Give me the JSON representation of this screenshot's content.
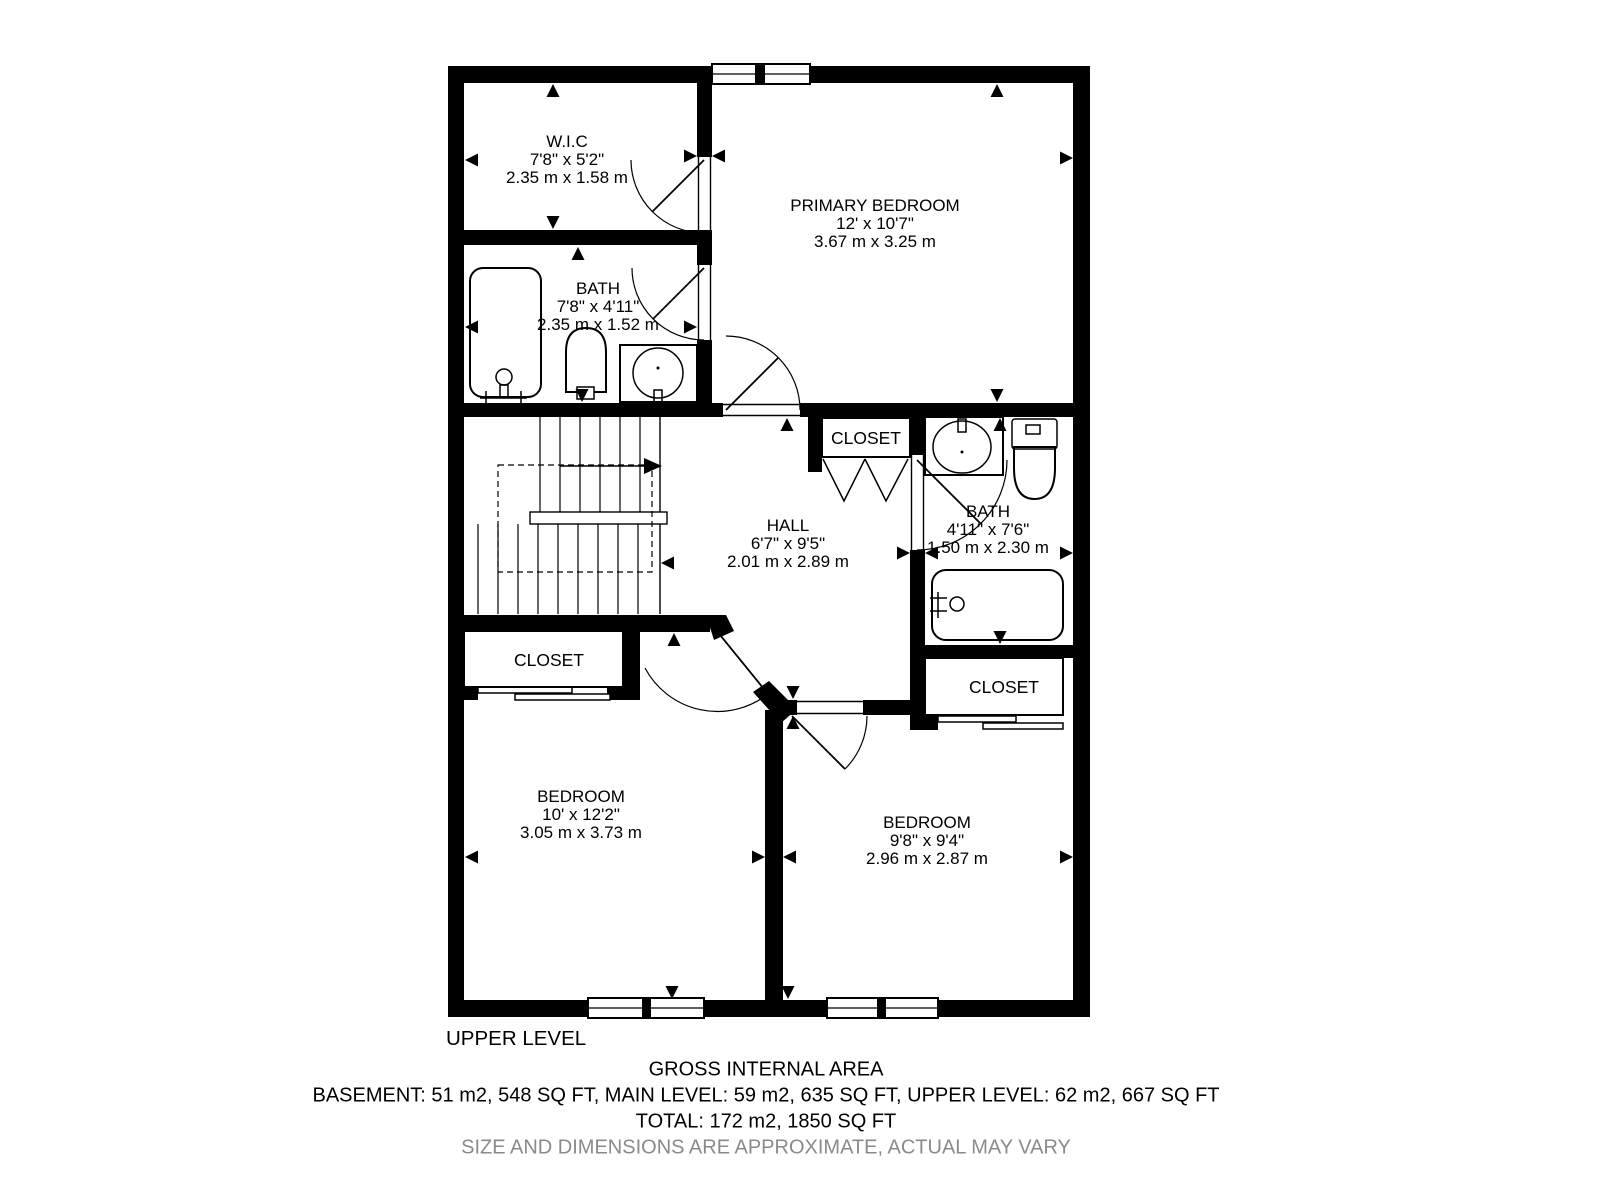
{
  "plan": {
    "level_label": "UPPER LEVEL",
    "rooms": {
      "wic": {
        "name": "W.I.C",
        "imperial": "7'8\" x 5'2\"",
        "metric": "2.35 m x 1.58 m"
      },
      "primary_bedroom": {
        "name": "PRIMARY BEDROOM",
        "imperial": "12' x 10'7\"",
        "metric": "3.67 m x 3.25 m"
      },
      "bath_upper": {
        "name": "BATH",
        "imperial": "7'8\" x 4'11\"",
        "metric": "2.35 m x 1.52 m"
      },
      "hall": {
        "name": "HALL",
        "imperial": "6'7\" x 9'5\"",
        "metric": "2.01 m x 2.89 m"
      },
      "bath_right": {
        "name": "BATH",
        "imperial": "4'11\" x 7'6\"",
        "metric": "1.50 m x 2.30 m"
      },
      "bedroom_left": {
        "name": "BEDROOM",
        "imperial": "10' x 12'2\"",
        "metric": "3.05 m x 3.73 m"
      },
      "bedroom_right": {
        "name": "BEDROOM",
        "imperial": "9'8\" x 9'4\"",
        "metric": "2.96 m x 2.87 m"
      }
    },
    "closets": {
      "hall_closet": "CLOSET",
      "left_bedroom_closet": "CLOSET",
      "right_bedroom_closet": "CLOSET"
    }
  },
  "footer": {
    "gross_internal_area_title": "GROSS INTERNAL AREA",
    "areas_line": "BASEMENT: 51 m2, 548 SQ FT, MAIN LEVEL: 59 m2, 635 SQ FT, UPPER LEVEL: 62 m2, 667 SQ FT",
    "total_line": "TOTAL: 172 m2, 1850 SQ FT",
    "disclaimer": "SIZE AND DIMENSIONS ARE APPROXIMATE, ACTUAL MAY VARY"
  },
  "colors": {
    "walls": "#000000",
    "background": "#ffffff",
    "disclaimer_text": "#8a8a8a"
  }
}
